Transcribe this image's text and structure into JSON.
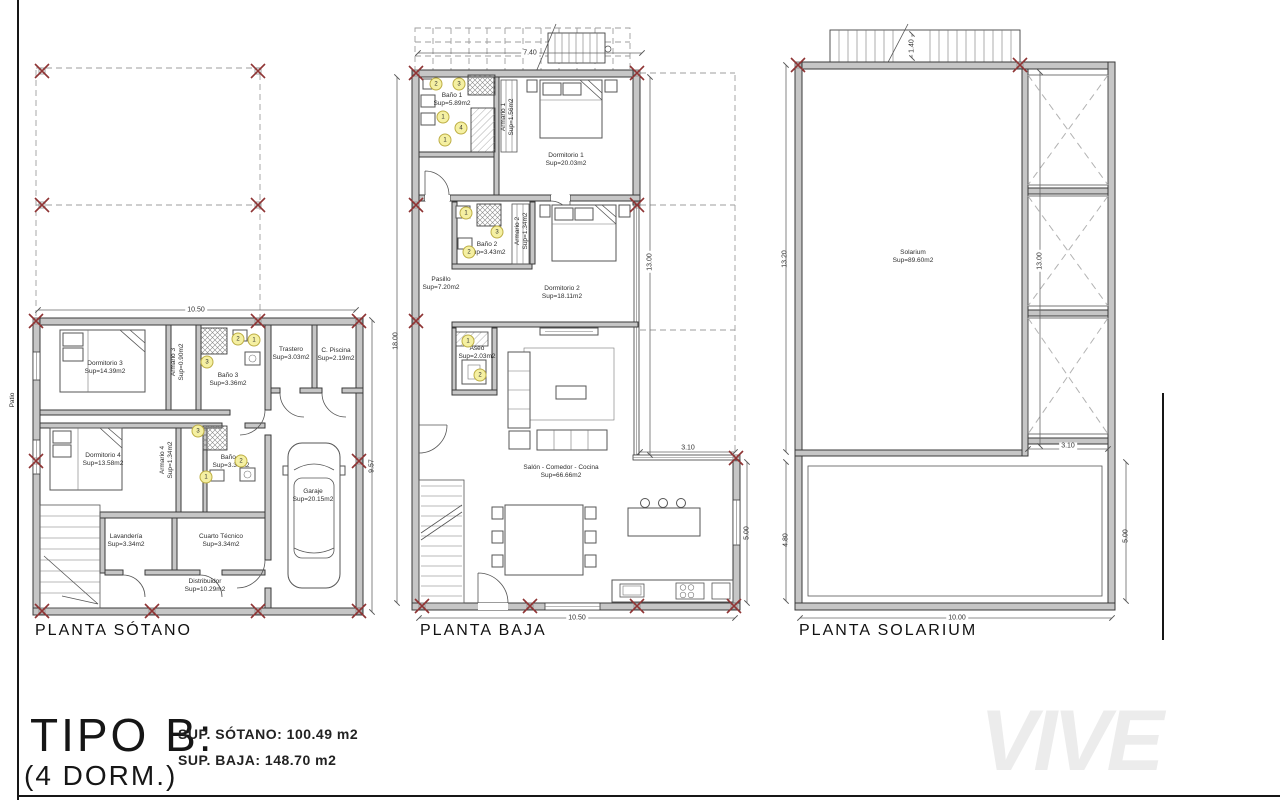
{
  "summary": {
    "type_label": "TIPO B:",
    "dorms_label": "(4 DORM.)",
    "area_sotano": "SUP. SÓTANO: 100.49 m2",
    "area_baja": "SUP. BAJA: 148.70 m2"
  },
  "watermark": "VIVE",
  "plans": [
    {
      "title": "PLANTA SÓTANO",
      "rooms": [
        {
          "name": "Dormitorio 3",
          "area": "Sup=14.39m2"
        },
        {
          "name": "Armario 3",
          "area": "Sup=0.90m2"
        },
        {
          "name": "Baño 3",
          "area": "Sup=3.36m2"
        },
        {
          "name": "Trastero",
          "area": "Sup=3.03m2"
        },
        {
          "name": "C. Piscina",
          "area": "Sup=2.19m2"
        },
        {
          "name": "Dormitorio 4",
          "area": "Sup=13.58m2"
        },
        {
          "name": "Armario 4",
          "area": "Sup=1.34m2"
        },
        {
          "name": "Baño 4",
          "area": "Sup=3.36m2"
        },
        {
          "name": "Garaje",
          "area": "Sup=20.15m2"
        },
        {
          "name": "Lavandería",
          "area": "Sup=3.34m2"
        },
        {
          "name": "Cuarto Técnico",
          "area": "Sup=3.34m2"
        },
        {
          "name": "Distribuidor",
          "area": "Sup=10.29m2"
        },
        {
          "name": "Patio",
          "area": ""
        }
      ],
      "dims": {
        "top": "10.50",
        "right": "9.57"
      },
      "tags": [
        "2",
        "1",
        "3",
        "3",
        "2",
        "1"
      ]
    },
    {
      "title": "PLANTA BAJA",
      "rooms": [
        {
          "name": "Baño 1",
          "area": "Sup=5.89m2"
        },
        {
          "name": "Armario 1",
          "area": "Sup=1.56m2"
        },
        {
          "name": "Dormitorio 1",
          "area": "Sup=20.03m2"
        },
        {
          "name": "Baño 2",
          "area": "Sup=3.43m2"
        },
        {
          "name": "Armario 2",
          "area": "Sup=1.34m2"
        },
        {
          "name": "Dormitorio 2",
          "area": "Sup=18.11m2"
        },
        {
          "name": "Pasillo",
          "area": "Sup=7.20m2"
        },
        {
          "name": "Aseo",
          "area": "Sup=2.03m2"
        },
        {
          "name": "Salón - Comedor - Cocina",
          "area": "Sup=66.66m2"
        }
      ],
      "dims": {
        "top": "7.40",
        "left": "18.00",
        "right_upper": "13.00",
        "notch": "3.10",
        "right_lower": "5.00",
        "bottom": "10.50"
      },
      "tags": [
        "2",
        "3",
        "1",
        "4",
        "1",
        "1",
        "3",
        "2",
        "1",
        "2"
      ]
    },
    {
      "title": "PLANTA SOLARIUM",
      "rooms": [
        {
          "name": "Solarium",
          "area": "Sup=89.60m2"
        }
      ],
      "dims": {
        "stair": "1.40",
        "left": "13.20",
        "right_upper": "13.00",
        "notch": "3.10",
        "left_lower": "4.80",
        "right_lower": "5.00",
        "bottom": "10.00"
      }
    }
  ]
}
